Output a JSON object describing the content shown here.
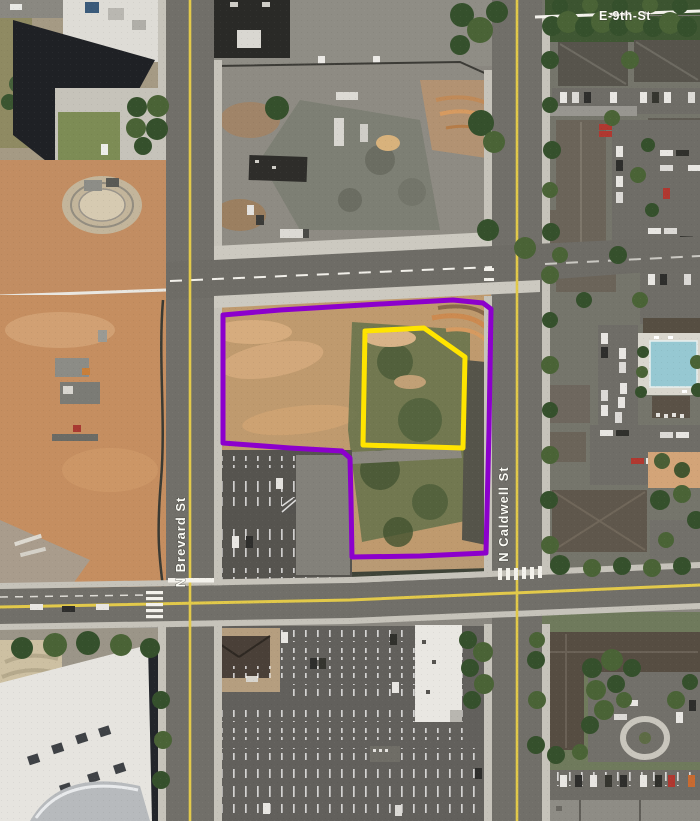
{
  "map": {
    "street_labels": {
      "e9th": "E-9th-St",
      "brevard": "N Brevard St",
      "caldwell": "N Caldwell St"
    },
    "annotations": {
      "site_boundary": {
        "color": "#8C00CC",
        "points": "223,315 280,310 380,304 453,300 483,303 491,309 489,430 486,553 420,556 352,557 351,500 350,458 342,451 290,448 223,443"
      },
      "inner_parcel": {
        "color": "#FFE400",
        "points": "365,331 424,328 465,357 463,448 363,445"
      }
    },
    "road_markings": {
      "center_line_yellow": "#E2C94A",
      "lane_line_white": "#F2F0EA"
    }
  }
}
